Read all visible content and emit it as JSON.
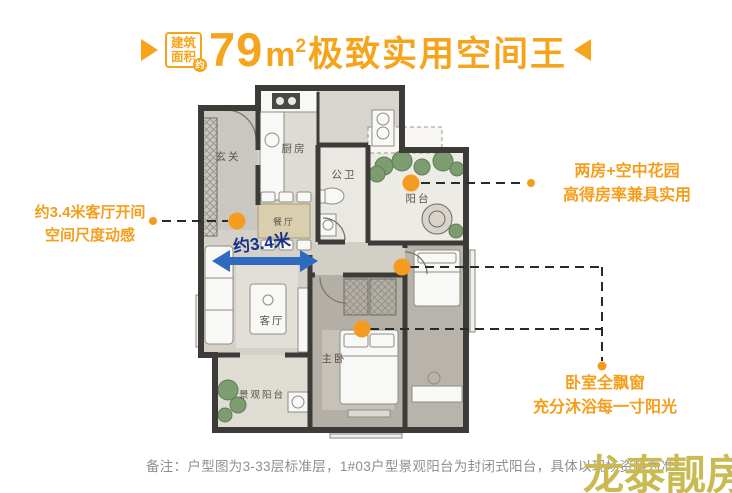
{
  "header": {
    "badge": {
      "line1": "建筑",
      "line2": "面积",
      "circle": "约"
    },
    "title": {
      "number": "79",
      "unit": "m",
      "sup": "2",
      "text": "极致实用空间王"
    }
  },
  "floorplan": {
    "labels": {
      "entry": "玄关",
      "kitchen": "厨房",
      "bath": "公卫",
      "sky_balcony": "阳台",
      "dining": "餐厅",
      "living": "客厅",
      "master": "主卧",
      "view_balcony": "景观阳台"
    },
    "dimension": {
      "label": "约3.4米"
    }
  },
  "annotations": {
    "left": {
      "line1": "约3.4米客厅开间",
      "line2": "空间尺度动感"
    },
    "right_top": {
      "line1": "两房+空中花园",
      "line2": "高得房率兼具实用"
    },
    "right_bottom": {
      "line1": "卧室全飘窗",
      "line2": "充分沐浴每一寸阳光"
    }
  },
  "footer": {
    "note": "备注：户型图为3-33层标准层，1#03户型景观阳台为封闭式阳台，具体以现场资料为准"
  },
  "watermark": {
    "text": "龙泰靓房"
  },
  "colors": {
    "accent_orange": "#F7A41D",
    "dot_orange": "#F59B1E",
    "arrow_blue": "#2E6BBF",
    "arrow_text_navy": "#16338C",
    "note_gray": "#8F8F8F",
    "watermark_khaki": "#C9BA52",
    "wall_dark": "#3D3B37"
  }
}
